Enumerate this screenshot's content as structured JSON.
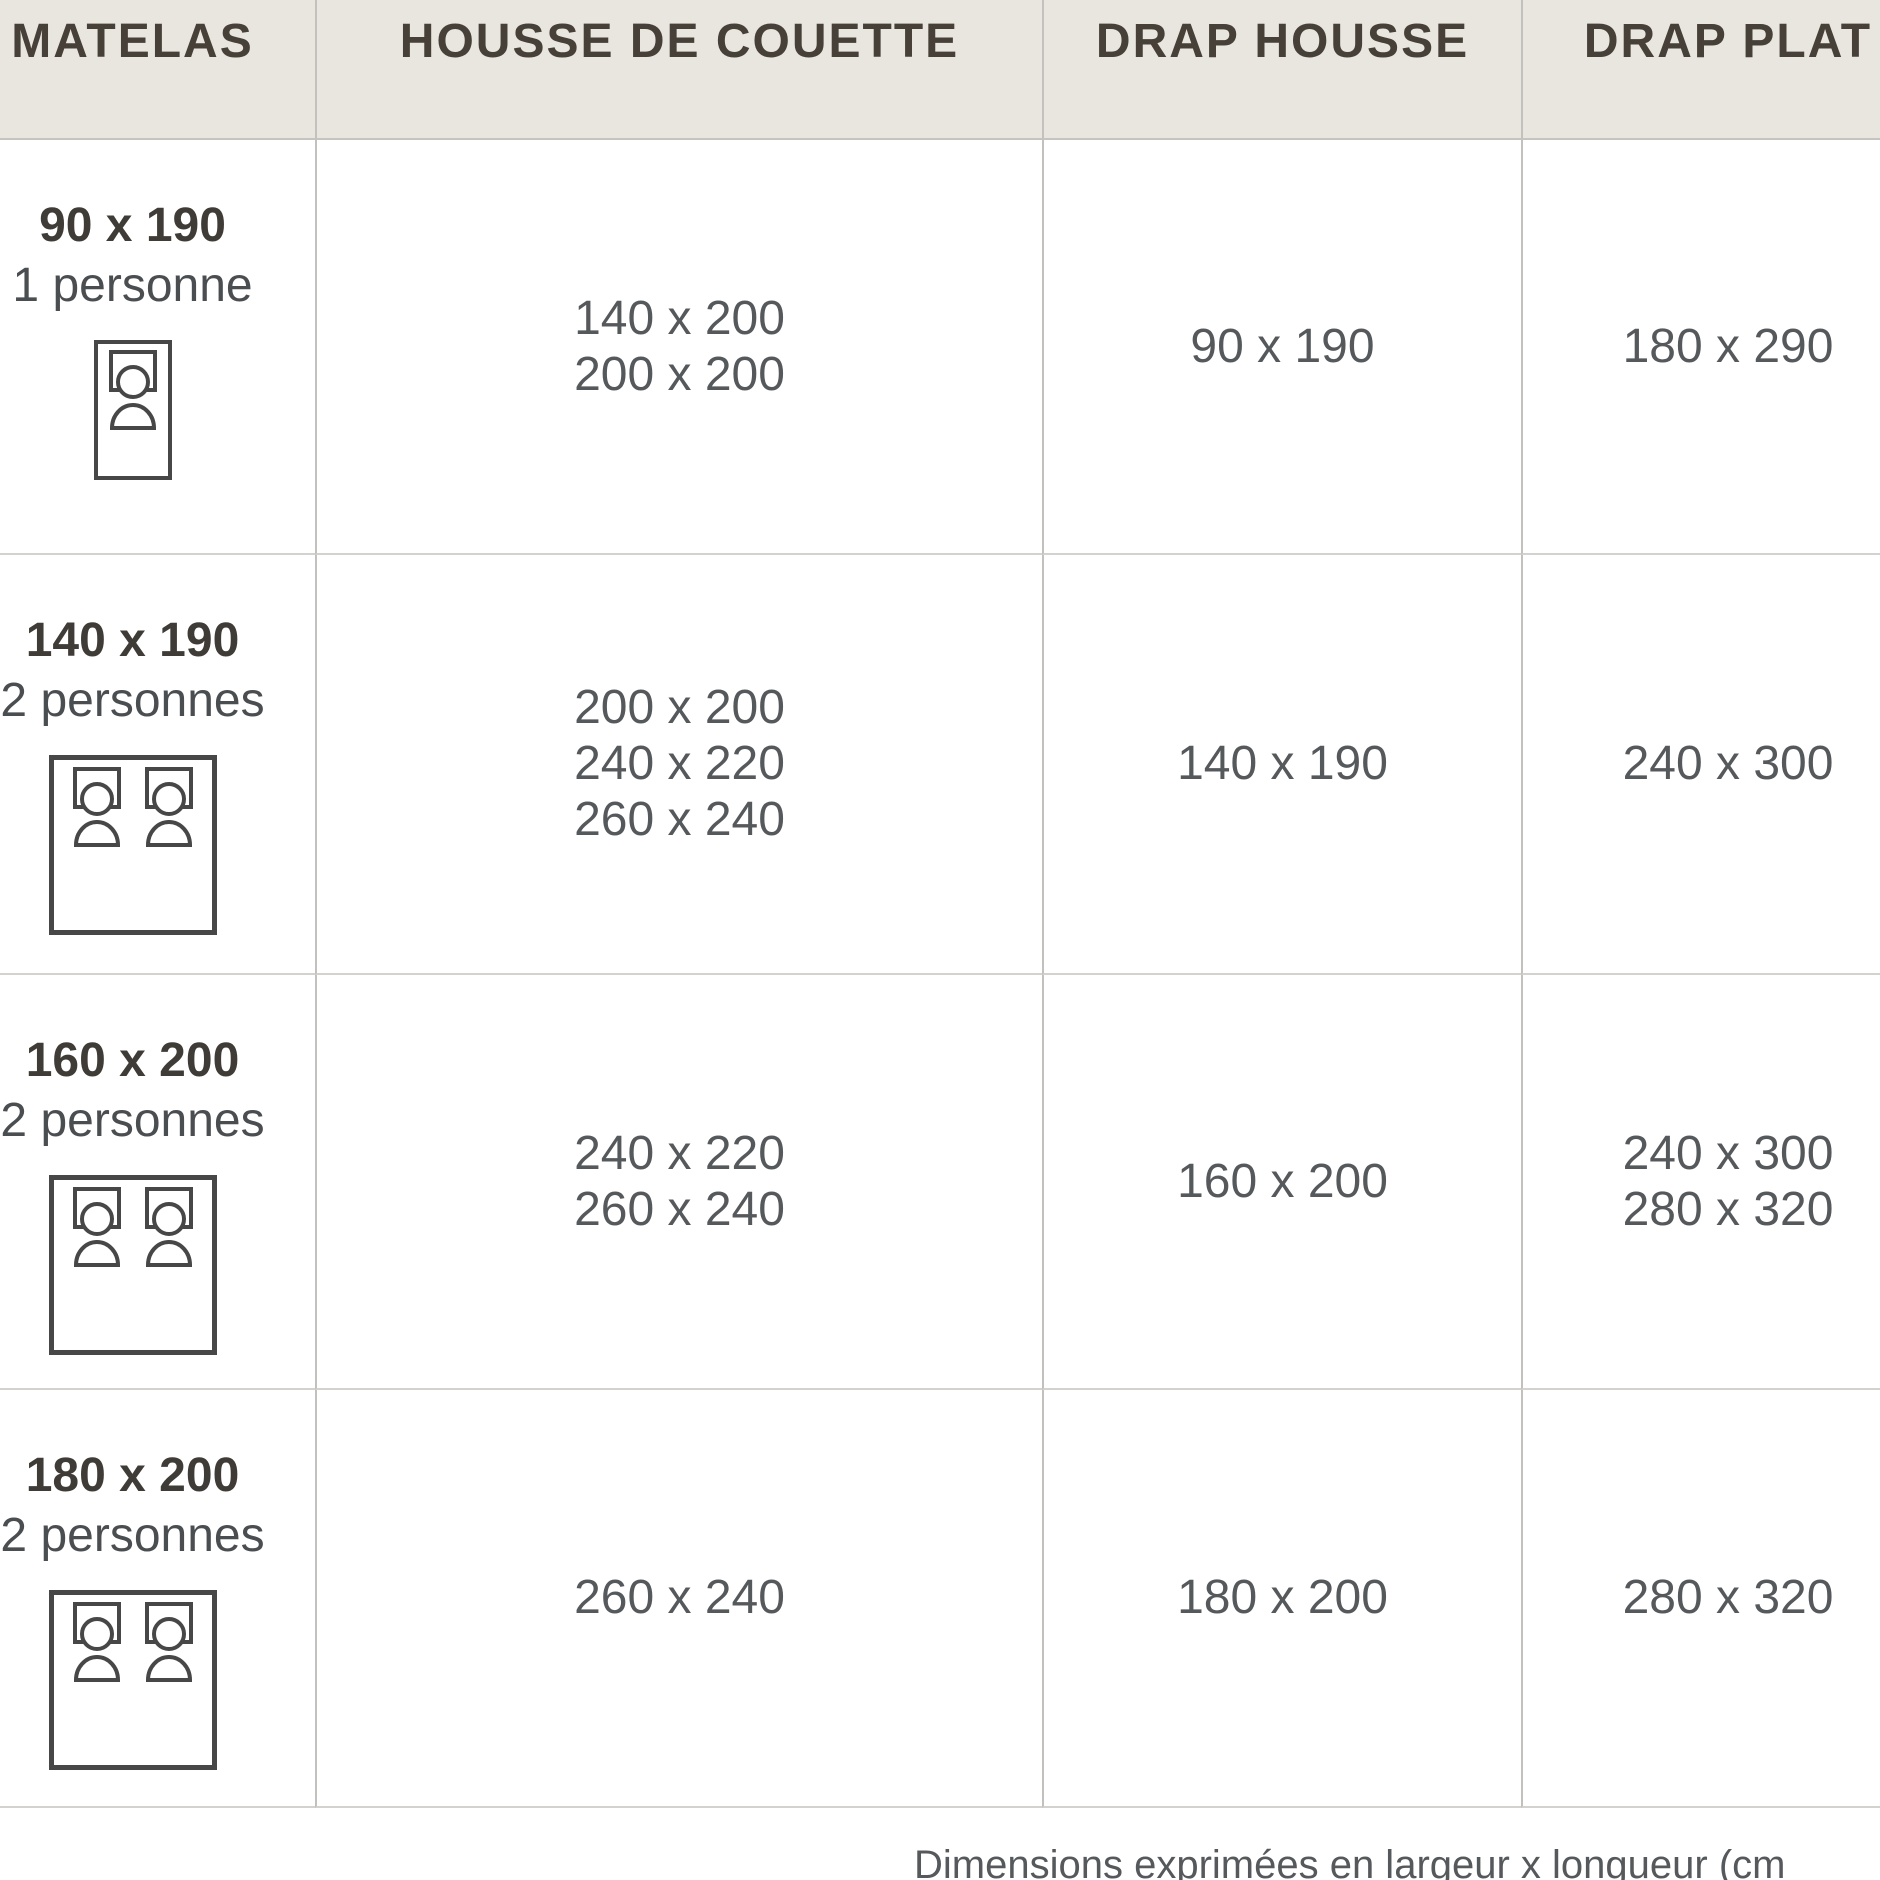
{
  "chart_data": {
    "type": "table",
    "title": "Guide des tailles de linge de lit",
    "columns": [
      "MATELAS",
      "HOUSSE DE COUETTE",
      "DRAP HOUSSE",
      "DRAP PLAT"
    ],
    "rows": [
      {
        "matelas": "90 x 190",
        "personnes": "1 personne",
        "bed_icon": "single-bed",
        "housse_de_couette": [
          "140 x 200",
          "200 x 200"
        ],
        "drap_housse": "90 x 190",
        "drap_plat": [
          "180 x 290"
        ]
      },
      {
        "matelas": "140 x 190",
        "personnes": "2 personnes",
        "bed_icon": "double-bed",
        "housse_de_couette": [
          "200 x 200",
          "240 x 220",
          "260 x 240"
        ],
        "drap_housse": "140 x 190",
        "drap_plat": [
          "240 x 300"
        ]
      },
      {
        "matelas": "160 x 200",
        "personnes": "2 personnes",
        "bed_icon": "double-bed",
        "housse_de_couette": [
          "240 x 220",
          "260 x 240"
        ],
        "drap_housse": "160 x 200",
        "drap_plat": [
          "240 x 300",
          "280 x 320"
        ]
      },
      {
        "matelas": "180 x 200",
        "personnes": "2 personnes",
        "bed_icon": "double-bed",
        "housse_de_couette": [
          "260 x 240"
        ],
        "drap_housse": "180 x 200",
        "drap_plat": [
          "280 x 320"
        ]
      }
    ],
    "note": "Dimensions exprimées en largeur x longueur (cm",
    "layout_hints": {
      "grid": true,
      "header_position": "top",
      "left_column_cropped": true,
      "right_column_cropped": true
    }
  },
  "colors": {
    "background": "#ffffff",
    "header_bg": "#e9e6e0",
    "header_text": "#474039",
    "label_text": "#3f3b37",
    "value_text": "#56595c",
    "border_vertical": "#c3c1bd",
    "border_horizontal": "#d4d2ce",
    "icon_stroke": "#474747"
  }
}
